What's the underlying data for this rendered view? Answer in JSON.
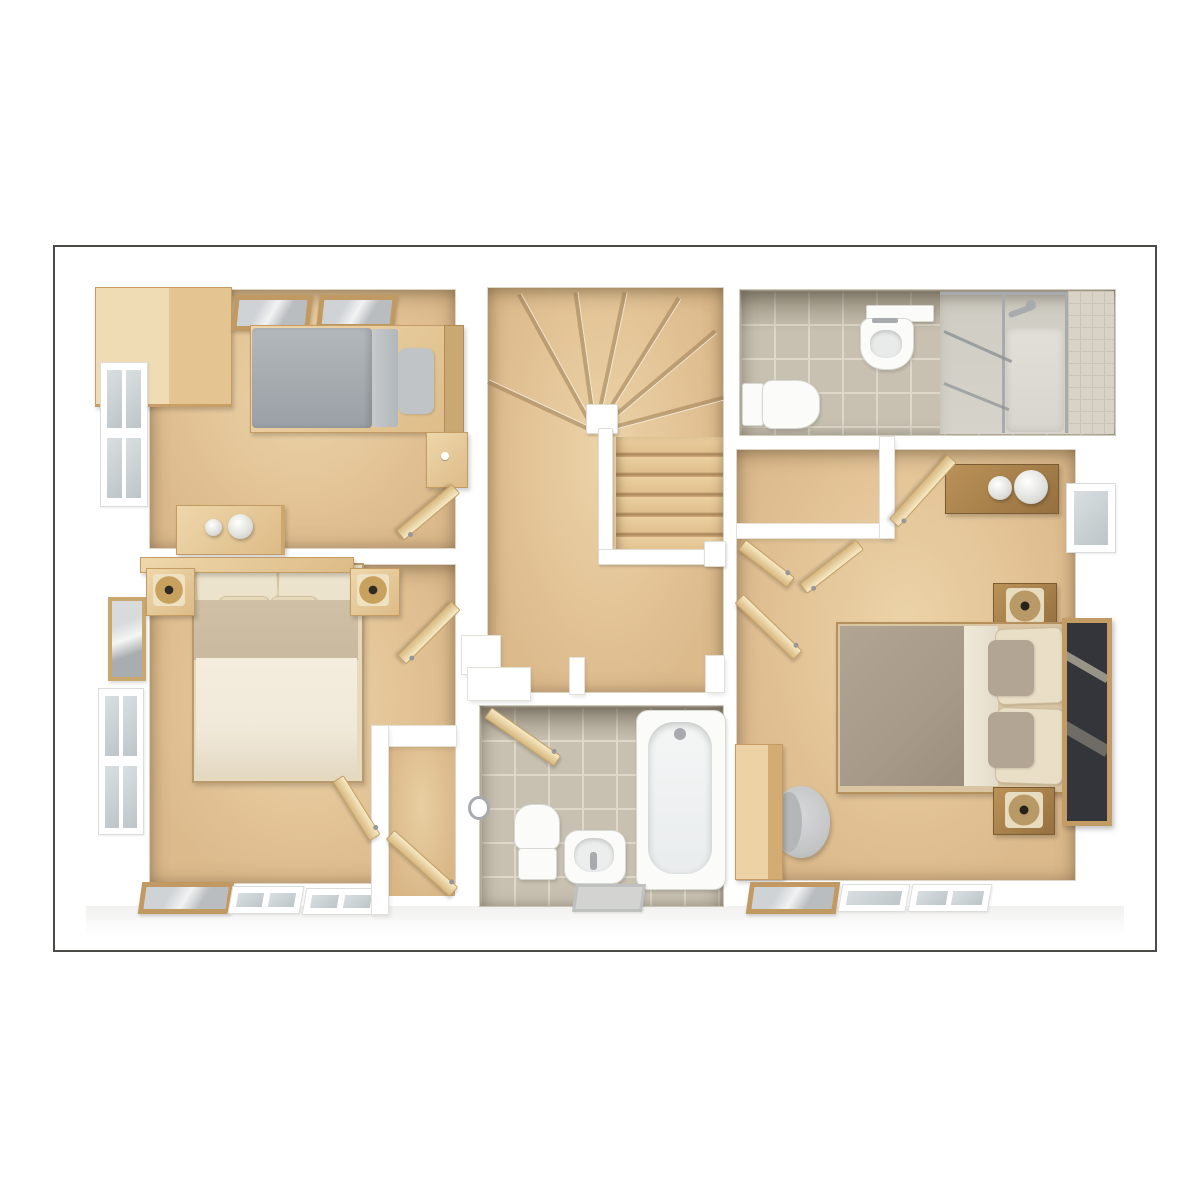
{
  "meta": {
    "title": "3D floor plan - first floor (top-down dollhouse render)",
    "style": "photoreal 3D render, no text labels visible"
  },
  "colors": {
    "page_bg": "#ffffff",
    "border": "#4b4a47",
    "wall_edge": "#e4e1da",
    "carpet": "#dcba8c",
    "carpet_light": "#ecd3a8",
    "tile": "#c8c1b1",
    "grout": "#ded8ca",
    "shower_tile": "#d4cfc2",
    "wood_light": "#eed7ab",
    "wood_mid": "#ddbb87",
    "wood_edge": "#c49c63",
    "fixture_white": "#fbfbfa",
    "fixture_edge": "#d8d8d2",
    "chrome": "#a7abae",
    "glass_pane": "#ccd3d6",
    "duvet_gray": "#a9aeb3",
    "pillow_gray": "#c0c4c7",
    "duvet_taupe_master": "#a89a88",
    "linen_cream": "#ece3cc",
    "duvet_taupe_b2": "#c9b99f",
    "duvet_cream_b2": "#f0e9d9",
    "mirror_glass": "#34353a",
    "lamp_gold": "#c9a15f"
  },
  "rooms": [
    {
      "id": "bedroom-3",
      "name": "Bedroom 3 (single)",
      "floor": "carpet",
      "furniture": [
        "single-bed-gray",
        "corner-wardrobe",
        "desk-with-lamps",
        "bedside-table",
        "two-picture-frames",
        "side-window",
        "open-door"
      ]
    },
    {
      "id": "bedroom-2",
      "name": "Bedroom 2 (double)",
      "floor": "carpet",
      "furniture": [
        "double-bed-cream",
        "bedside-table-left",
        "bedside-table-right",
        "table-lamps",
        "wall-picture",
        "side-window",
        "floor-frames",
        "storage-cupboard",
        "open-doors"
      ]
    },
    {
      "id": "landing",
      "name": "Landing",
      "floor": "carpet",
      "furniture": [
        "winder-staircase",
        "straight-flight",
        "handrail-and-newel",
        "stair-bulkhead"
      ]
    },
    {
      "id": "en-suite",
      "name": "En-suite shower room",
      "floor": "tile",
      "furniture": [
        "toilet",
        "wall-basin-with-shelf",
        "shower-enclosure"
      ]
    },
    {
      "id": "master-bedroom",
      "name": "Master bedroom",
      "floor": "carpet",
      "furniture": [
        "double-bed-taupe",
        "bedside-table-top",
        "bedside-table-bottom",
        "dresser-with-two-lamps",
        "built-in-wardrobe-nook",
        "leaning-mirror",
        "chair",
        "tall-cabinet",
        "side-window",
        "floor-frames",
        "open-doors"
      ]
    },
    {
      "id": "bathroom",
      "name": "Bathroom",
      "floor": "tile",
      "furniture": [
        "bathtub",
        "toilet",
        "pedestal-basin",
        "bath-mat",
        "towel-ring",
        "open-door"
      ]
    }
  ]
}
